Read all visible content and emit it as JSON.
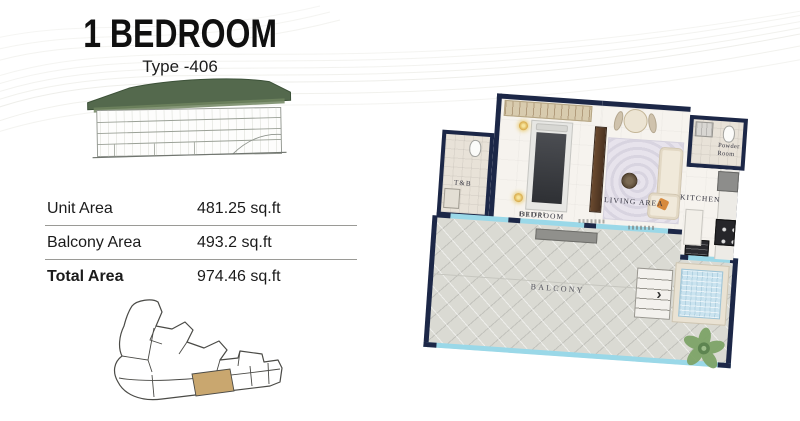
{
  "header": {
    "title": "1 BEDROOM",
    "subtitle": "Type -406"
  },
  "area_table": {
    "rows": [
      {
        "label": "Unit Area",
        "value": "481.25 sq.ft"
      },
      {
        "label": "Balcony Area",
        "value": "493.2 sq.ft"
      },
      {
        "label": "Total Area",
        "value": "974.46 sq.ft"
      }
    ]
  },
  "floor_plan": {
    "labels": {
      "bedroom": "BEDROOM",
      "living": "LIVING AREA",
      "kitchen": "KITCHEN",
      "powder_line1": "Powder",
      "powder_line2": "Room",
      "toilet_bath": "T&B",
      "balcony": "BALCONY"
    },
    "colors": {
      "wall": "#1c2747",
      "glass": "#9ad8e8",
      "balcony_floor": "#dadad3",
      "interior_floor": "#f6f3ee",
      "pool_water": "#cae3ef",
      "roof_green": "#54694d",
      "keyplan_highlight": "#c9a76f"
    }
  }
}
